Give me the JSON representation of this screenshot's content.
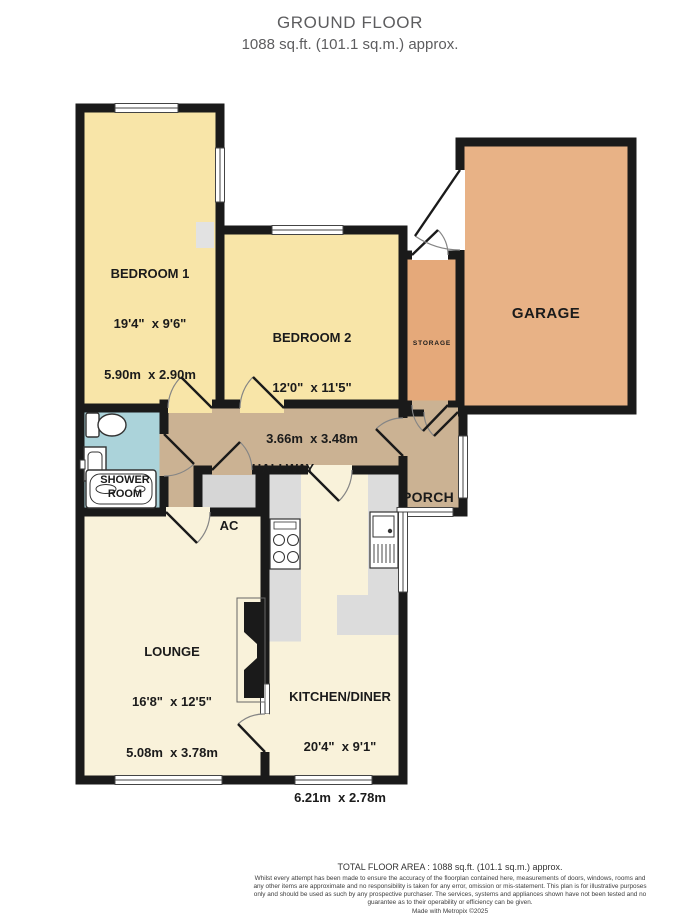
{
  "header": {
    "title": "GROUND FLOOR",
    "subtitle": "1088 sq.ft. (101.1 sq.m.) approx."
  },
  "rooms": {
    "bedroom1": {
      "name": "BEDROOM 1",
      "imperial": "19'4\"  x 9'6\"",
      "metric": "5.90m  x 2.90m"
    },
    "bedroom2": {
      "name": "BEDROOM 2",
      "imperial": "12'0\"  x 11'5\"",
      "metric": "3.66m  x 3.48m"
    },
    "garage": {
      "name": "GARAGE"
    },
    "storage": {
      "name": "STORAGE"
    },
    "hallway": {
      "name": "HALLWAY"
    },
    "porch": {
      "name": "PORCH"
    },
    "shower_room": {
      "name": "SHOWER ROOM"
    },
    "ac": {
      "name": "AC"
    },
    "lounge": {
      "name": "LOUNGE",
      "imperial": "16'8\"  x 12'5\"",
      "metric": "5.08m  x 3.78m"
    },
    "kitchen_diner": {
      "name": "KITCHEN/DINER",
      "imperial": "20'4\"  x 9'1\"",
      "metric": "6.21m  x 2.78m"
    }
  },
  "icons": {
    "toilet": "toilet-icon",
    "basin": "bathroom-sink-icon",
    "bath": "bath-icon",
    "stove": "stove-icon",
    "kitchen_sink": "kitchen-sink-icon"
  },
  "colors": {
    "wall": "#1a1a1a",
    "bedroom": "#f8e5a8",
    "garage": "#e8b286",
    "storage": "#e5a97a",
    "hallway": "#cbb293",
    "shower": "#abd3da",
    "lounge": "#f9f2da",
    "kitchen": "#f9f2da",
    "closet": "#d6d6d6",
    "counter": "#dcdcdc",
    "window": "#ffffff"
  },
  "footer": {
    "total_area": "TOTAL FLOOR AREA : 1088 sq.ft. (101.1 sq.m.) approx.",
    "disclaimer": "Whilst every attempt has been made to ensure the accuracy of the floorplan contained here, measurements of doors, windows, rooms and any other items are approximate and no responsibility is taken for any error, omission or mis-statement. This plan is for illustrative purposes only and should be used as such by any prospective purchaser. The services, systems and appliances shown have not been tested and no guarantee as to their operability or efficiency can be given.",
    "credit": "Made with Metropix ©2025"
  }
}
